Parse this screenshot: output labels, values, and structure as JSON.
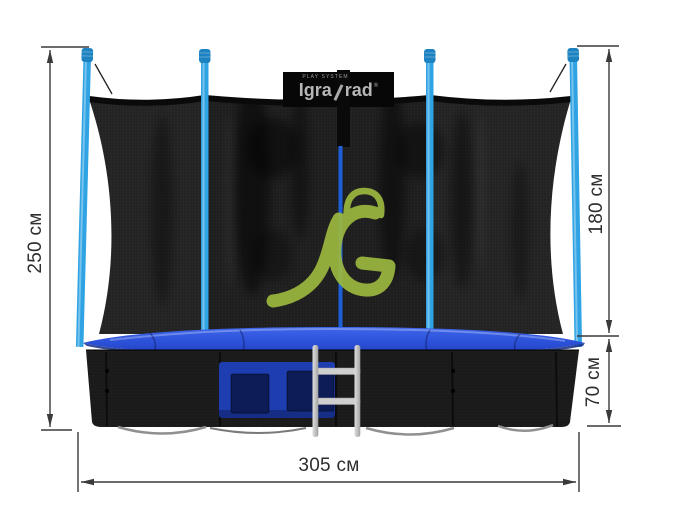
{
  "scene": {
    "background": "#ffffff"
  },
  "brand_patch": {
    "top_text": "PLAY SYSTEM",
    "name_left": "Igra",
    "name_right": "rad",
    "registered": "®"
  },
  "dimensions": {
    "overall_height": "250 см",
    "net_height": "180 см",
    "frame_height": "70 см",
    "width": "305 см"
  },
  "colors": {
    "pole_blue": "#2fa3e3",
    "pole_cap_blue": "#1c82c0",
    "pad_blue_top": "#3e66ea",
    "pad_blue_bottom": "#1c38ae",
    "pocket_panel_blue": "#1d3db0",
    "pocket_inner_navy": "#0d1c56",
    "zipper_blue": "#1e5fd8",
    "logo_green": "#9cb93f",
    "net_black": "#222222",
    "ladder_silver": "#cccccc",
    "dimension_line": "#3a3a3a"
  }
}
